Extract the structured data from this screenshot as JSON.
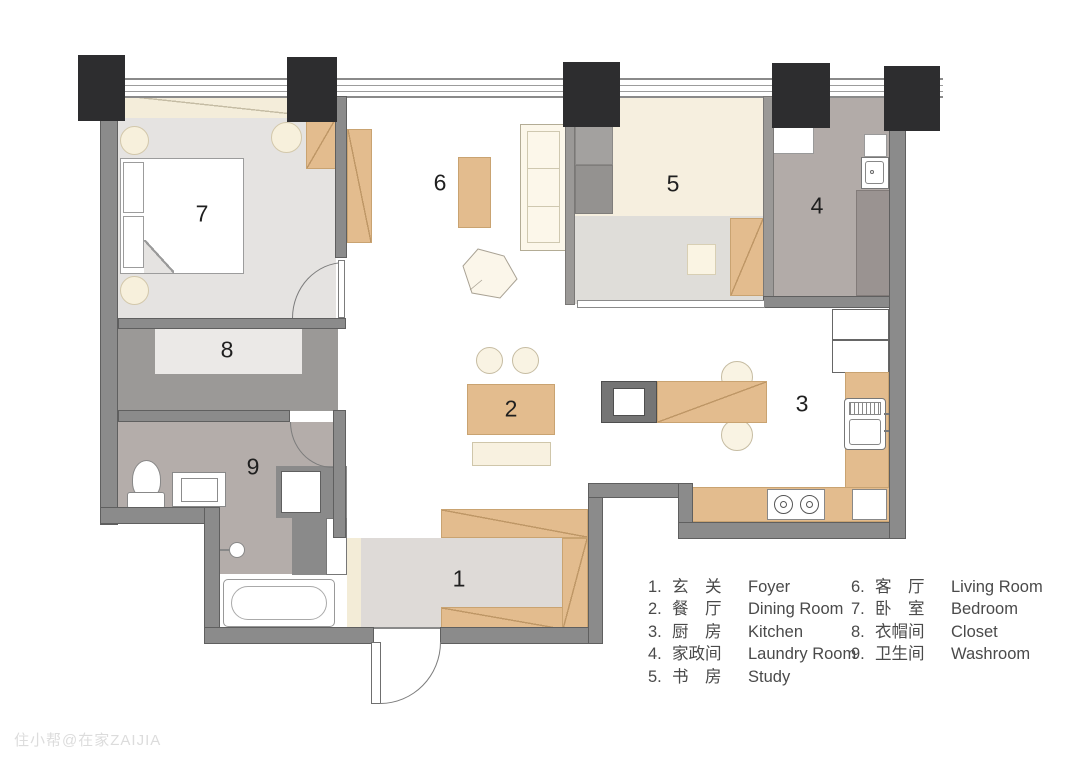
{
  "watermark": "住小帮@在家ZAIJIA",
  "plan": {
    "room_labels": [
      {
        "num": "1",
        "name": "Foyer"
      },
      {
        "num": "2",
        "name": "Dining Room"
      },
      {
        "num": "3",
        "name": "Kitchen"
      },
      {
        "num": "4",
        "name": "Laundry Room"
      },
      {
        "num": "5",
        "name": "Study"
      },
      {
        "num": "6",
        "name": "Living Room"
      },
      {
        "num": "7",
        "name": "Bedroom"
      },
      {
        "num": "8",
        "name": "Closet"
      },
      {
        "num": "9",
        "name": "Washroom"
      }
    ]
  },
  "legend": {
    "columns": [
      {
        "items": [
          {
            "num": "1.",
            "zh": "玄　关",
            "en": "Foyer"
          },
          {
            "num": "2.",
            "zh": "餐　厅",
            "en": "Dining Room"
          },
          {
            "num": "3.",
            "zh": "厨　房",
            "en": "Kitchen"
          },
          {
            "num": "4.",
            "zh": "家政间",
            "en": "Laundry Room"
          },
          {
            "num": "5.",
            "zh": "书　房",
            "en": "Study"
          }
        ]
      },
      {
        "items": [
          {
            "num": "6.",
            "zh": "客　厅",
            "en": "Living Room"
          },
          {
            "num": "7.",
            "zh": "卧　室",
            "en": "Bedroom"
          },
          {
            "num": "8.",
            "zh": "衣帽间",
            "en": "Closet"
          },
          {
            "num": "9.",
            "zh": "卫生间",
            "en": "Washroom"
          }
        ]
      }
    ]
  },
  "colors": {
    "wall": "#8b8b8b",
    "column": "#2d2d2f",
    "wood": "#e3bc8e",
    "cream_floor": "#f6efdf",
    "gray_floor": "#e5e3e1",
    "mauve_floor": "#b4adaa"
  }
}
